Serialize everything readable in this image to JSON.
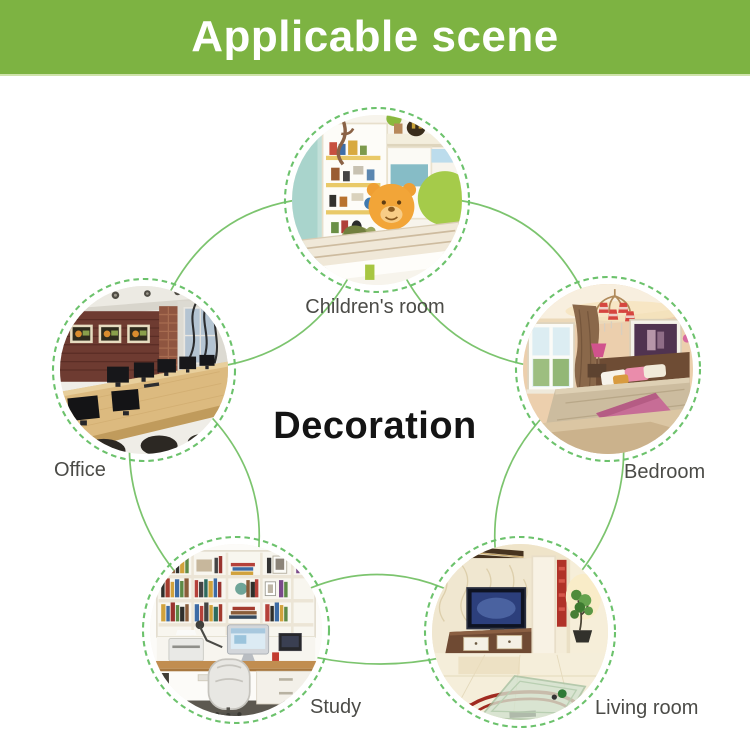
{
  "header": {
    "title": "Applicable scene"
  },
  "center": {
    "label": "Decoration"
  },
  "nodes": [
    {
      "id": "childrens-room",
      "label": "Children's room"
    },
    {
      "id": "bedroom",
      "label": "Bedroom"
    },
    {
      "id": "living-room",
      "label": "Living room"
    },
    {
      "id": "study",
      "label": "Study"
    },
    {
      "id": "office",
      "label": "Office"
    }
  ],
  "colors": {
    "header_bg": "#7db342",
    "header_text": "#ffffff",
    "connector_green": "#7cc46e",
    "ring_green": "#6cc26c",
    "label_text": "#4b4b47",
    "center_text": "#141414",
    "page_bg": "#ffffff"
  }
}
